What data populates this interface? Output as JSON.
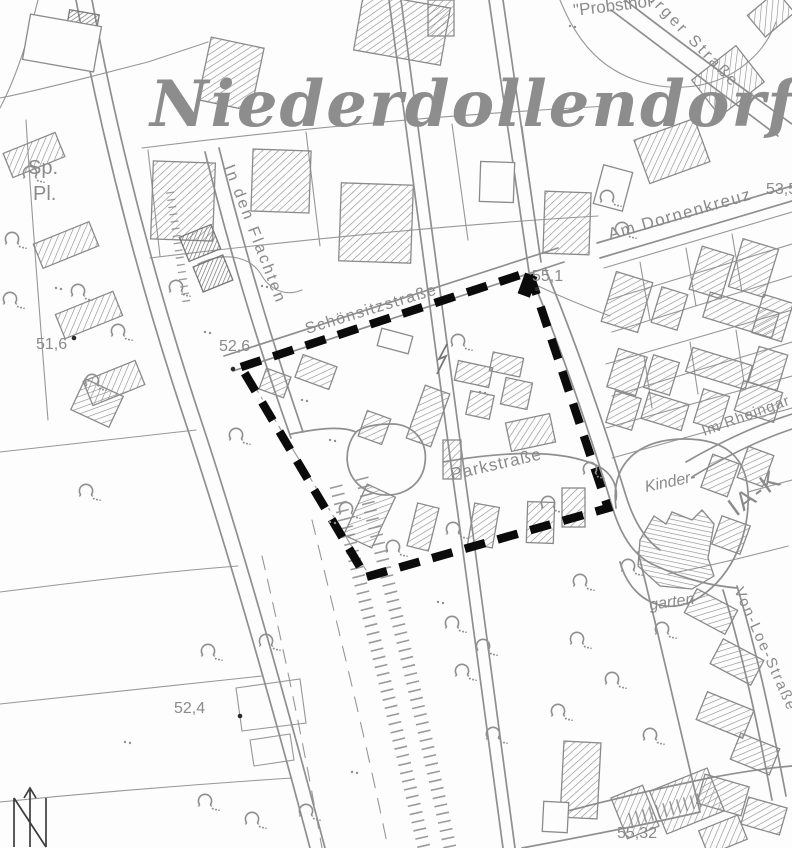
{
  "map": {
    "title": "Niederdollendorf",
    "streets": {
      "schoensitzstrasse": "Schönsitzstraße",
      "in_den_flachten": "In den Flachten",
      "am_dornenkreuz": "Am Dornenkreuz",
      "urger_strasse": "urger Straße",
      "parkstrasse": "Parkstraße",
      "im_rheingarten": "Im Rheingar",
      "von_loe_strasse": "Von-Loe-Straße"
    },
    "places": {
      "probsthof": "\"Probsthof \"",
      "sportplatz_line1": "Sp.",
      "sportplatz_line2": "Pl.",
      "kindergarten_line1": "Kinder-",
      "kindergarten_line2": "garten",
      "zone_code": "IA-K"
    },
    "elevations": {
      "sportplatz_west": "51,6",
      "schoensitz_corner": "52,6",
      "boundary_ne": "55,1",
      "dornenkreuz_east": "53,5",
      "bottom_left": "52,4",
      "bottom_right": "55,32"
    },
    "colors": {
      "background": "#fdfdfd",
      "linework": "#8f8f8f",
      "title_gray": "#8d8d8d",
      "boundary": "#0b0b0b"
    }
  }
}
